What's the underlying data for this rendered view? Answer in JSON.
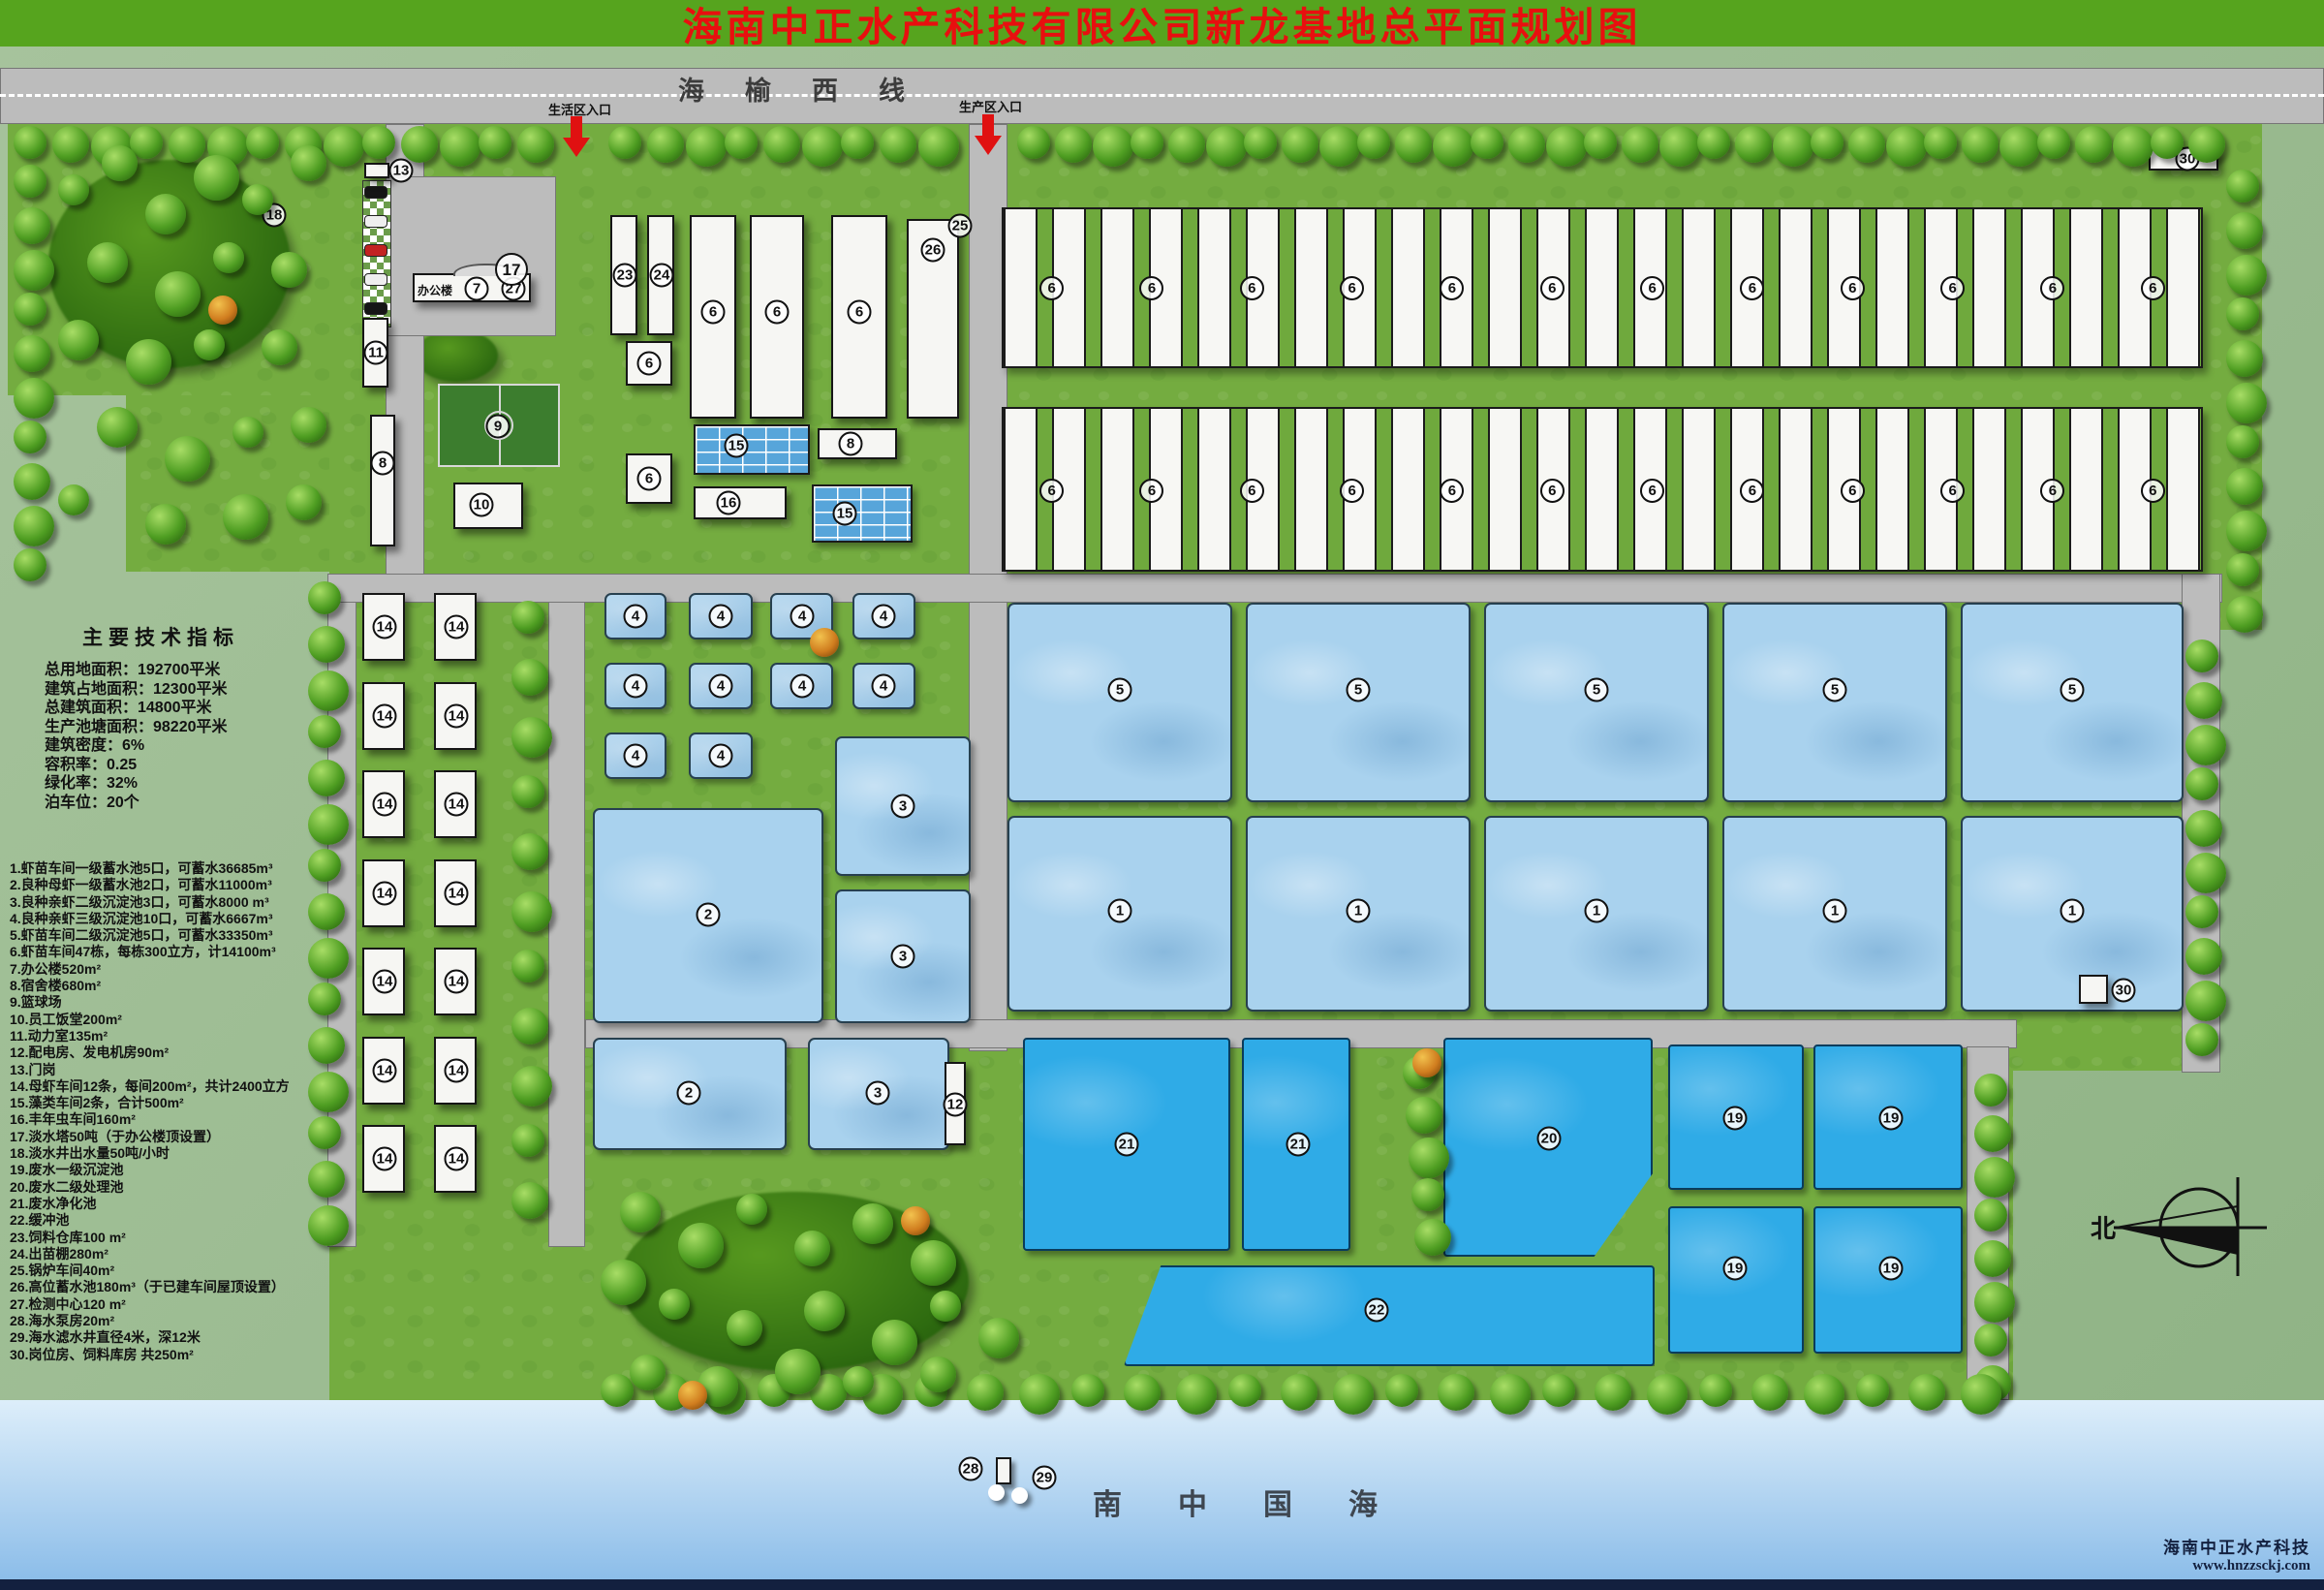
{
  "title": "海南中正水产科技有限公司新龙基地总平面规划图",
  "road": {
    "name": "海榆西线",
    "entrance_life": "生活区入口",
    "entrance_production": "生产区入口"
  },
  "indicators": {
    "heading": "主要技术指标",
    "lines": [
      "总用地面积：192700平米",
      "建筑占地面积：12300平米",
      "总建筑面积：14800平米",
      "生产池塘面积：98220平米",
      "建筑密度：6%",
      "容积率：0.25",
      "绿化率：32%",
      "泊车位：20个"
    ]
  },
  "legend": {
    "items": [
      "1.虾苗车间一级蓄水池5口，可蓄水36685m³",
      "2.良种母虾一级蓄水池2口，可蓄水11000m³",
      "3.良种亲虾二级沉淀池3口，可蓄水8000 m³",
      "4.良种亲虾三级沉淀池10口，可蓄水6667m³",
      "5.虾苗车间二级沉淀池5口，可蓄水33350m³",
      "6.虾苗车间47栋，每栋300立方，计14100m³",
      "7.办公楼520m²",
      "8.宿舍楼680m²",
      "9.篮球场",
      "10.员工饭堂200m²",
      "11.动力室135m²",
      "12.配电房、发电机房90m²",
      "13.门岗",
      "14.母虾车间12条，每间200m²，共计2400立方",
      "15.藻类车间2条，合计500m²",
      "16.丰年虫车间160m²",
      "17.淡水塔50吨（于办公楼顶设置）",
      "18.淡水井出水量50吨/小时",
      "19.废水一级沉淀池",
      "20.废水二级处理池",
      "21.废水净化池",
      "22.缓冲池",
      "23.饲料仓库100 m²",
      "24.出苗棚280m²",
      "25.锅炉车间40m²",
      "26.高位蓄水池180m³（于已建车间屋顶设置）",
      "27.检测中心120 m²",
      "28.海水泵房20m²",
      "29.海水滤水井直径4米，深12米",
      "30.岗位房、饲料库房 共250m²"
    ]
  },
  "map": {
    "office_label": "办公楼",
    "strip_row_a": [
      "6",
      "6",
      "6",
      "6",
      "6",
      "6",
      "6",
      "6",
      "6",
      "6",
      "6",
      "6"
    ],
    "strip_row_b": [
      "6",
      "6",
      "6",
      "6",
      "6",
      "6",
      "6",
      "6",
      "6",
      "6",
      "6",
      "6"
    ]
  },
  "markers": {
    "n1": "1",
    "n2": "2",
    "n3": "3",
    "n4": "4",
    "n5": "5",
    "n6": "6",
    "n7": "7",
    "n8": "8",
    "n9": "9",
    "n10": "10",
    "n11": "11",
    "n12": "12",
    "n13": "13",
    "n14": "14",
    "n15": "15",
    "n16": "16",
    "n17": "17",
    "n18": "18",
    "n19": "19",
    "n20": "20",
    "n21": "21",
    "n22": "22",
    "n23": "23",
    "n24": "24",
    "n25": "25",
    "n26": "26",
    "n27": "27",
    "n28": "28",
    "n29": "29",
    "n30": "30"
  },
  "sea": {
    "name": "南中国海"
  },
  "compass": {
    "north": "北"
  },
  "footer": {
    "company": "海南中正水产科技",
    "website": "www.hnzzsckj.com"
  },
  "colors": {
    "title_band": "#56a41e",
    "title_text": "#e80f0f",
    "road": "#bcbcbc",
    "grass": "#74ac40",
    "pond_light": "#a9d2ee",
    "pond_deep": "#2fabe7",
    "sea_top": "#ddeefa",
    "sea_bottom": "#8cbde9",
    "footer_navy": "#13203f"
  }
}
